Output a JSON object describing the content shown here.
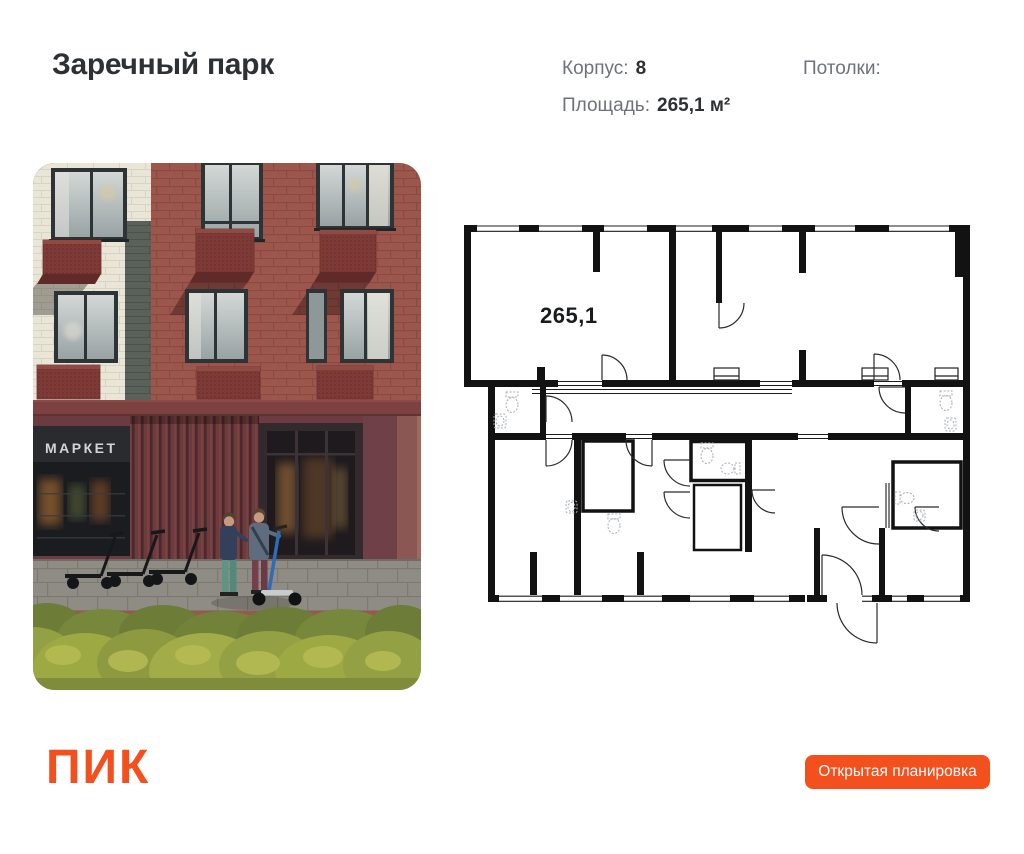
{
  "header": {
    "project_title": "Заречный парк",
    "korpus": {
      "label": "Корпус:",
      "value": "8"
    },
    "ceilings": {
      "label": "Потолки:"
    },
    "area": {
      "label": "Площадь:",
      "value": "265,1 м²"
    }
  },
  "photo": {
    "market_sign": "МАРКЕТ"
  },
  "floorplan": {
    "area_label": "265,1"
  },
  "footer": {
    "logo_text": "ПИК",
    "button_label": "Открытая планировка"
  },
  "colors": {
    "accent": "#f4501e",
    "text_dark": "#2e3134",
    "text_gray": "#6e7277",
    "plan_wall": "#121212"
  }
}
